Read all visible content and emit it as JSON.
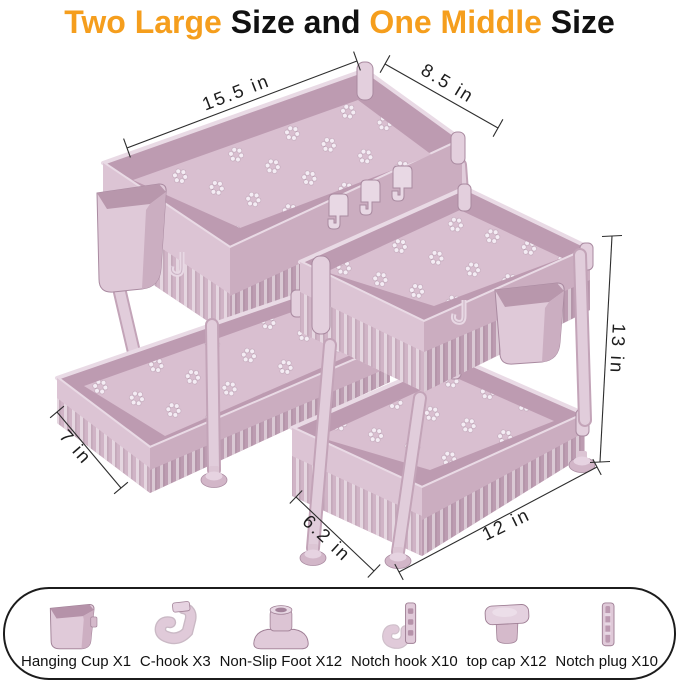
{
  "title": {
    "segments": [
      {
        "text": "Two Large",
        "color": "#F59E1D"
      },
      {
        "text": " Size and ",
        "color": "#111111"
      },
      {
        "text": "One Middle",
        "color": "#F59E1D"
      },
      {
        "text": " Size",
        "color": "#111111"
      }
    ]
  },
  "dimensions": {
    "large_top_width": "15.5 in",
    "large_top_depth": "8.5 in",
    "large_drawer_depth": "7 in",
    "middle_height": "13 in",
    "middle_bottom_depth": "6.2 in",
    "middle_bottom_width": "12 in"
  },
  "accessories": [
    {
      "label": "Hanging Cup X1",
      "icon": "hanging-cup-icon"
    },
    {
      "label": "C-hook X3",
      "icon": "c-hook-icon"
    },
    {
      "label": "Non-Slip Foot X12",
      "icon": "non-slip-foot-icon"
    },
    {
      "label": "Notch hook X10",
      "icon": "notch-hook-icon"
    },
    {
      "label": "top cap X12",
      "icon": "top-cap-icon"
    },
    {
      "label": "Notch plug X10",
      "icon": "notch-plug-icon"
    }
  ],
  "colors": {
    "accent_orange": "#F59E1D",
    "text_black": "#111111",
    "product_pink": "#DCC4D4",
    "product_shadow": "#BD9BB1",
    "product_light": "#E9DAE5",
    "dimension_line": "#2D2D2D",
    "panel_border": "#1C1C1C",
    "background": "#FFFFFF"
  }
}
